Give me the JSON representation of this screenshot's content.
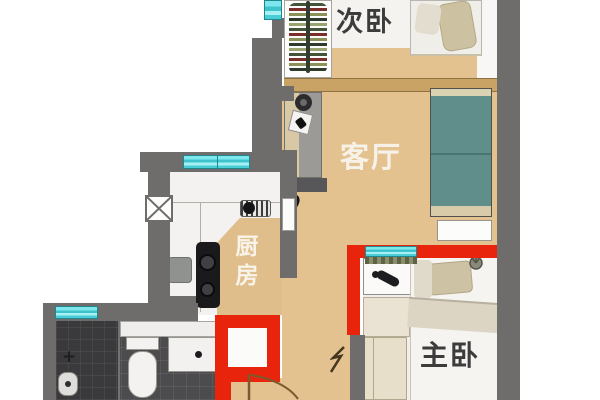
{
  "plan": {
    "title": "apartment-floor-plan",
    "rooms": [
      {
        "key": "secondary-bedroom",
        "label": "次卧"
      },
      {
        "key": "living-room",
        "label": "客厅"
      },
      {
        "key": "kitchen",
        "label": "厨房"
      },
      {
        "key": "master-bedroom",
        "label": "主卧"
      }
    ],
    "symbols": {
      "shower_fixture": "+"
    },
    "colors": {
      "wall": "#6e6d6b",
      "red": "#e8250c",
      "wood": "#e3c28f",
      "woodDark": "#c9a265",
      "teal": "#54d8de",
      "sofa": "#5f8e8b",
      "bathFloor": "#4c4c4e",
      "kitchenTan": "#dfbe8c"
    }
  }
}
